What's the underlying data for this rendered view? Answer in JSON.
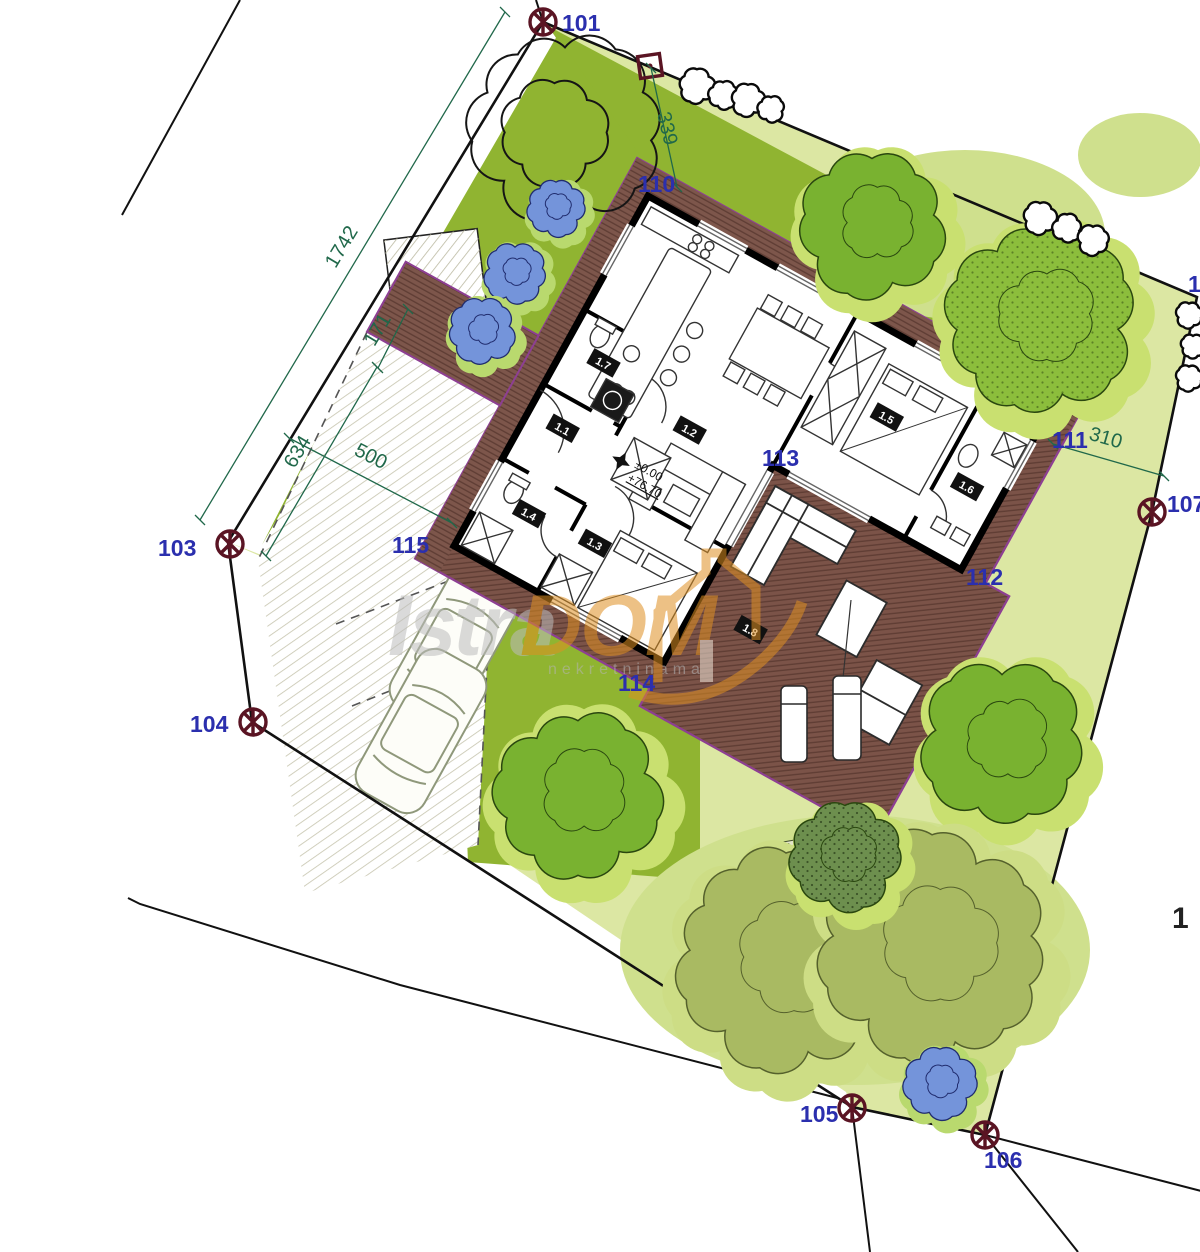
{
  "title": "Site plan with family house floor plan",
  "watermark": {
    "brand_gray": "Istra",
    "brand_orange": "DOM",
    "subtext": "nekretninama"
  },
  "elevation": {
    "level": "±0.00",
    "absolute": "+76.70"
  },
  "survey_points": {
    "p101": "101",
    "p103": "103",
    "p104": "104",
    "p105": "105",
    "p106": "106",
    "p107": "107"
  },
  "area_labels": {
    "a110": "110",
    "a111": "111",
    "a112": "112",
    "a113": "113",
    "a114": "114",
    "a115": "115"
  },
  "partial_labels": {
    "right_top": "1",
    "right_mid": "1"
  },
  "dimensions": {
    "d1742": "1742",
    "d171": "171",
    "d634": "634",
    "d500": "500",
    "d339": "339",
    "d310": "310"
  },
  "rooms": {
    "r1_1": "1.1",
    "r1_2": "1.2",
    "r1_3": "1.3",
    "r1_4": "1.4",
    "r1_5": "1.5",
    "r1_6": "1.6",
    "r1_7": "1.7",
    "r1_8": "1.8"
  },
  "colors": {
    "lawn_light": "#dce7a3",
    "lawn_dark": "#90b431",
    "deck": "#7d564b",
    "deck_stripe": "#5e3c33",
    "deck_edge": "#8d3f92",
    "wall": "#000000",
    "label_blue": "#2b2fae",
    "dim_green": "#20684a",
    "marker_maroon": "#5a1423",
    "bush_blue": "#7494da",
    "bush_halo": "#b9d96e",
    "tree_green": "#79b230",
    "tree_halo": "#c9e070",
    "tree_olive": "#a9ba62",
    "tree_olive_halo": "#cddd85",
    "watermark_orange": "#df9022",
    "watermark_gray": "#bdbdbd"
  },
  "trees": [
    {
      "cx": 565,
      "cy": 128,
      "r": 88,
      "kind": "outline"
    },
    {
      "cx": 872,
      "cy": 226,
      "r": 66,
      "kind": "green"
    },
    {
      "cx": 1040,
      "cy": 318,
      "r": 86,
      "kind": "dotted"
    },
    {
      "cx": 1002,
      "cy": 742,
      "r": 74,
      "kind": "green"
    },
    {
      "cx": 578,
      "cy": 795,
      "r": 76,
      "kind": "green"
    },
    {
      "cx": 786,
      "cy": 962,
      "r": 100,
      "kind": "olive"
    },
    {
      "cx": 932,
      "cy": 948,
      "r": 104,
      "kind": "olive"
    },
    {
      "cx": 845,
      "cy": 856,
      "r": 50,
      "kind": "dark"
    }
  ],
  "bushes": [
    {
      "cx": 556,
      "cy": 208,
      "r": 26
    },
    {
      "cx": 515,
      "cy": 273,
      "r": 28
    },
    {
      "cx": 482,
      "cy": 331,
      "r": 30
    },
    {
      "cx": 940,
      "cy": 1083,
      "r": 33
    }
  ],
  "shrubs": [
    {
      "cx": 697,
      "cy": 86,
      "r": 16
    },
    {
      "cx": 723,
      "cy": 95,
      "r": 13
    },
    {
      "cx": 748,
      "cy": 100,
      "r": 15
    },
    {
      "cx": 771,
      "cy": 109,
      "r": 12
    },
    {
      "cx": 1040,
      "cy": 218,
      "r": 15
    },
    {
      "cx": 1067,
      "cy": 228,
      "r": 13
    },
    {
      "cx": 1093,
      "cy": 240,
      "r": 14
    },
    {
      "cx": 1189,
      "cy": 315,
      "r": 12
    },
    {
      "cx": 1193,
      "cy": 346,
      "r": 11
    },
    {
      "cx": 1189,
      "cy": 378,
      "r": 12
    }
  ]
}
